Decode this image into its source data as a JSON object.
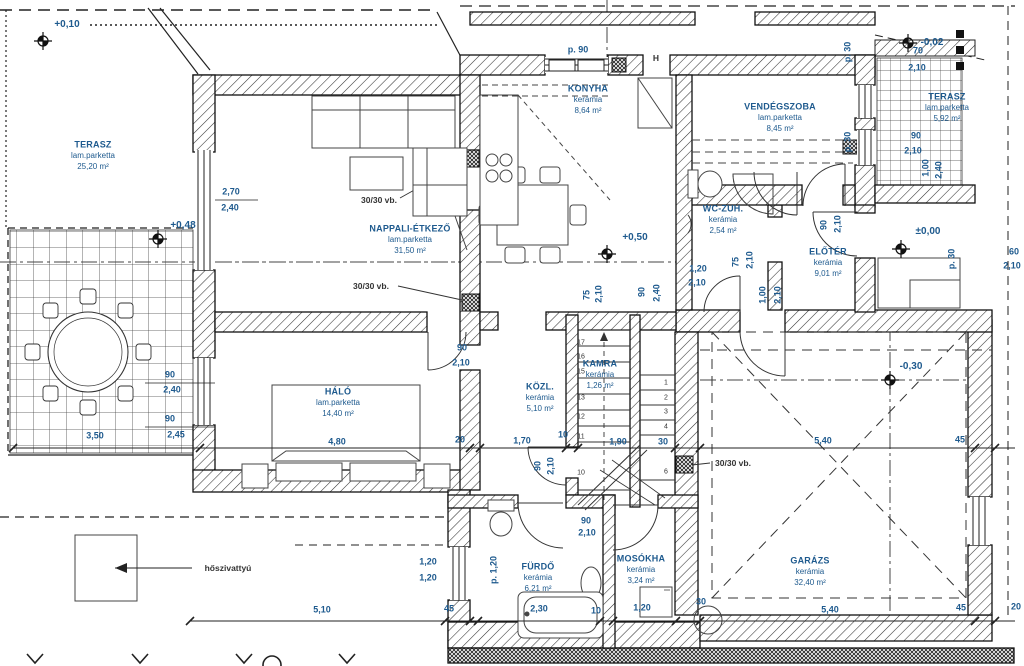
{
  "drawing": {
    "accent_color": "#1e5a8e",
    "line_color": "#1a1a1a"
  },
  "rooms": [
    {
      "id": "terasz-left",
      "name": "TERASZ",
      "floor": "lam.parketta",
      "area": "25,20 m²",
      "x": 93,
      "y": 145
    },
    {
      "id": "nappali-etkezo",
      "name": "NAPPALI-ÉTKEZŐ",
      "floor": "lam.parketta",
      "area": "31,50 m²",
      "x": 410,
      "y": 229
    },
    {
      "id": "konyha",
      "name": "KONYHA",
      "floor": "kerámia",
      "area": "8,64 m²",
      "x": 588,
      "y": 89
    },
    {
      "id": "vendegszoba",
      "name": "VENDÉGSZOBA",
      "floor": "lam.parketta",
      "area": "8,45 m²",
      "x": 780,
      "y": 107
    },
    {
      "id": "wc-zuh",
      "name": "WC-ZUH.",
      "floor": "kerámia",
      "area": "2,54 m²",
      "x": 723,
      "y": 209
    },
    {
      "id": "eloter",
      "name": "ELŐTÉR",
      "floor": "kerámia",
      "area": "9,01 m²",
      "x": 828,
      "y": 252
    },
    {
      "id": "terasz-right",
      "name": "TERASZ",
      "floor": "lam.parketta",
      "area": "5,92 m²",
      "x": 947,
      "y": 97
    },
    {
      "id": "halo",
      "name": "HÁLÓ",
      "floor": "lam.parketta",
      "area": "14,40 m²",
      "x": 338,
      "y": 392
    },
    {
      "id": "kozl",
      "name": "KÖZL.",
      "floor": "kerámia",
      "area": "5,10 m²",
      "x": 540,
      "y": 387
    },
    {
      "id": "kamra",
      "name": "KAMRA",
      "floor": "kerámia",
      "area": "1,26 m²",
      "x": 600,
      "y": 364
    },
    {
      "id": "furdo",
      "name": "FÜRDŐ",
      "floor": "kerámia",
      "area": "6,21 m²",
      "x": 538,
      "y": 567
    },
    {
      "id": "mosokha",
      "name": "MOSÓKHA",
      "floor": "kerámia",
      "area": "3,24 m²",
      "x": 641,
      "y": 559
    },
    {
      "id": "garazs",
      "name": "GARÁZS",
      "floor": "kerámia",
      "area": "32,40 m²",
      "x": 810,
      "y": 561
    }
  ],
  "levels": [
    {
      "text": "+0,10",
      "x": 67,
      "y": 25
    },
    {
      "text": "+0,48",
      "x": 183,
      "y": 226
    },
    {
      "text": "+0,50",
      "x": 635,
      "y": 238
    },
    {
      "text": "±0,00",
      "x": 928,
      "y": 232
    },
    {
      "text": "-0,02",
      "x": 932,
      "y": 43
    },
    {
      "text": "-0,30",
      "x": 911,
      "y": 367
    }
  ],
  "dimensions": [
    {
      "text": "2,70",
      "x": 231,
      "y": 192
    },
    {
      "text": "2,40",
      "x": 230,
      "y": 208
    },
    {
      "text": "90",
      "x": 170,
      "y": 375
    },
    {
      "text": "2,40",
      "x": 172,
      "y": 390
    },
    {
      "text": "90",
      "x": 170,
      "y": 419
    },
    {
      "text": "2,45",
      "x": 176,
      "y": 435
    },
    {
      "text": "3,50",
      "x": 95,
      "y": 436
    },
    {
      "text": "4,80",
      "x": 337,
      "y": 442
    },
    {
      "text": "20",
      "x": 460,
      "y": 440
    },
    {
      "text": "1,70",
      "x": 522,
      "y": 441
    },
    {
      "text": "10",
      "x": 563,
      "y": 435
    },
    {
      "text": "1,90",
      "x": 618,
      "y": 442
    },
    {
      "text": "30",
      "x": 663,
      "y": 442
    },
    {
      "text": "5,40",
      "x": 823,
      "y": 441
    },
    {
      "text": "45",
      "x": 960,
      "y": 440
    },
    {
      "text": "5,40",
      "x": 830,
      "y": 610
    },
    {
      "text": "45",
      "x": 961,
      "y": 608
    },
    {
      "text": "20",
      "x": 1016,
      "y": 607
    },
    {
      "text": "5,10",
      "x": 322,
      "y": 610
    },
    {
      "text": "45",
      "x": 449,
      "y": 609
    },
    {
      "text": "2,30",
      "x": 539,
      "y": 609
    },
    {
      "text": "10",
      "x": 596,
      "y": 611
    },
    {
      "text": "1,20",
      "x": 642,
      "y": 608
    },
    {
      "text": "30",
      "x": 701,
      "y": 602
    },
    {
      "text": "1,20",
      "x": 428,
      "y": 562
    },
    {
      "text": "1,20",
      "x": 428,
      "y": 578
    },
    {
      "text": "90",
      "x": 462,
      "y": 348
    },
    {
      "text": "2,10",
      "x": 461,
      "y": 363
    },
    {
      "text": "90",
      "x": 586,
      "y": 521
    },
    {
      "text": "2,10",
      "x": 587,
      "y": 533
    },
    {
      "text": "1,20",
      "x": 698,
      "y": 269
    },
    {
      "text": "2,10",
      "x": 697,
      "y": 283
    },
    {
      "text": "70",
      "x": 918,
      "y": 51
    },
    {
      "text": "2,10",
      "x": 917,
      "y": 68
    },
    {
      "text": "90",
      "x": 916,
      "y": 136
    },
    {
      "text": "2,10",
      "x": 913,
      "y": 151
    },
    {
      "text": "60",
      "x": 1014,
      "y": 252
    },
    {
      "text": "2,10",
      "x": 1012,
      "y": 266
    },
    {
      "text": "90",
      "x": 538,
      "y": 466,
      "rot": true
    },
    {
      "text": "2,10",
      "x": 551,
      "y": 466,
      "rot": true
    },
    {
      "text": "75",
      "x": 587,
      "y": 295,
      "rot": true
    },
    {
      "text": "2,10",
      "x": 599,
      "y": 294,
      "rot": true
    },
    {
      "text": "90",
      "x": 642,
      "y": 292,
      "rot": true
    },
    {
      "text": "2,40",
      "x": 657,
      "y": 293,
      "rot": true
    },
    {
      "text": "75",
      "x": 736,
      "y": 262,
      "rot": true
    },
    {
      "text": "2,10",
      "x": 750,
      "y": 260,
      "rot": true
    },
    {
      "text": "1,00",
      "x": 763,
      "y": 295,
      "rot": true
    },
    {
      "text": "2,10",
      "x": 778,
      "y": 295,
      "rot": true
    },
    {
      "text": "90",
      "x": 824,
      "y": 225,
      "rot": true
    },
    {
      "text": "2,10",
      "x": 838,
      "y": 224,
      "rot": true
    },
    {
      "text": "1,00",
      "x": 926,
      "y": 168,
      "rot": true
    },
    {
      "text": "2,40",
      "x": 939,
      "y": 170,
      "rot": true
    },
    {
      "text": "p. 1,20",
      "x": 494,
      "y": 570,
      "rot": true
    },
    {
      "text": "p. 30",
      "x": 848,
      "y": 52,
      "rot": true
    },
    {
      "text": "p. 30",
      "x": 848,
      "y": 142,
      "rot": true
    },
    {
      "text": "p. 30",
      "x": 952,
      "y": 259,
      "rot": true
    },
    {
      "text": "p. 90",
      "x": 578,
      "y": 50
    }
  ],
  "annotations": [
    {
      "text": "30/30 vb.",
      "x": 379,
      "y": 200
    },
    {
      "text": "30/30 vb.",
      "x": 371,
      "y": 286
    },
    {
      "text": "30/30 vb.",
      "x": 733,
      "y": 463
    },
    {
      "text": "hőszivattyú",
      "x": 228,
      "y": 568
    },
    {
      "text": "H",
      "x": 656,
      "y": 58
    }
  ],
  "stairs": {
    "numbers": [
      {
        "n": "17",
        "x": 581,
        "y": 343
      },
      {
        "n": "16",
        "x": 581,
        "y": 357
      },
      {
        "n": "15",
        "x": 581,
        "y": 372
      },
      {
        "n": "13",
        "x": 581,
        "y": 398
      },
      {
        "n": "12",
        "x": 581,
        "y": 417
      },
      {
        "n": "11",
        "x": 581,
        "y": 437
      },
      {
        "n": "10",
        "x": 581,
        "y": 473
      },
      {
        "n": "1",
        "x": 666,
        "y": 383
      },
      {
        "n": "2",
        "x": 666,
        "y": 398
      },
      {
        "n": "3",
        "x": 666,
        "y": 412
      },
      {
        "n": "4",
        "x": 666,
        "y": 427
      },
      {
        "n": "6",
        "x": 666,
        "y": 472
      }
    ]
  }
}
